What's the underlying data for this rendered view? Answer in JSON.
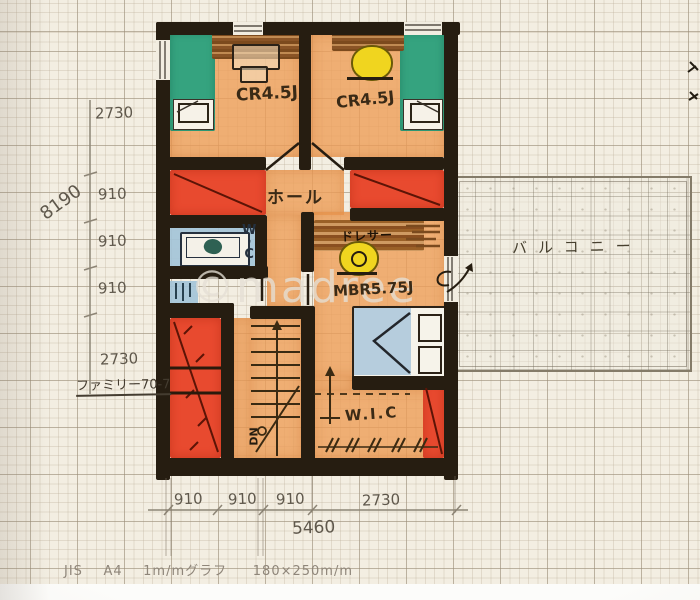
{
  "meta": {
    "watermark": "©madree",
    "paper_footer": "JIS    A4    1m/mグラフ     180×250m/m"
  },
  "palette": {
    "paper": "#f3eee2",
    "wall_ink": "#261d11",
    "floor_orange": "#ee9e58",
    "closet_red": "#e84a2f",
    "bed_green": "#35a37f",
    "water_blue": "#a4c4d8",
    "furniture_yellow": "#f0d51f",
    "wood_brown": "#8a5426",
    "pencil": "#5f584c"
  },
  "rooms": {
    "child_room_left": {
      "label": "CR4.5J"
    },
    "child_room_right": {
      "label": "CR4.5J"
    },
    "hall": {
      "label": "ホール"
    },
    "wc": {
      "chars": [
        "W",
        "·",
        "C"
      ]
    },
    "master_bedroom": {
      "label": "MBR5.75J",
      "dresser_label": "ドレサー"
    },
    "wic": {
      "label": "W.I.C"
    },
    "balcony": {
      "label": "バルコニー"
    },
    "stairs": {
      "down_label": "DN"
    }
  },
  "dimensions": {
    "left": [
      "2730",
      "910",
      "910",
      "910",
      "2730"
    ],
    "left_total": "8190",
    "left_note": "ファミリー70-7",
    "bottom": [
      "910",
      "910",
      "910",
      "2730"
    ],
    "bottom_total": "5460"
  }
}
